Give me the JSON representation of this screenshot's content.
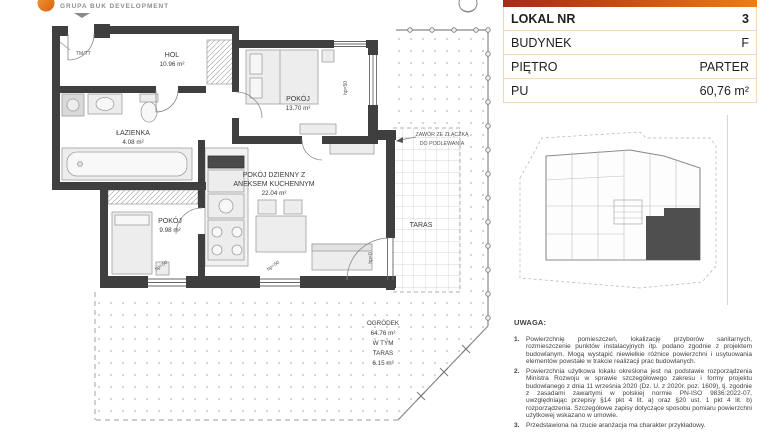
{
  "brand": {
    "logo_text": "GRUPA BUK DEVELOPMENT"
  },
  "info_table": {
    "rows": [
      {
        "label": "LOKAL NR",
        "value": "3"
      },
      {
        "label": "BUDYNEK",
        "value": "F"
      },
      {
        "label": "PIĘTRO",
        "value": "PARTER"
      },
      {
        "label": "PU",
        "value": "60,76 m²"
      }
    ]
  },
  "plan": {
    "rooms": {
      "hol": {
        "name": "HOL",
        "area": "10.96 m²"
      },
      "pokoj_top": {
        "name": "POKÓJ",
        "area": "13.70 m²"
      },
      "lazienka": {
        "name": "ŁAZIENKA",
        "area": "4.08 m²"
      },
      "living": {
        "name_line1": "POKÓJ DZIENNY Z",
        "name_line2": "ANEKSEM KUCHENNYM",
        "area": "22.04 m²"
      },
      "pokoj_bottom": {
        "name": "POKÓJ",
        "area": "9.98 m²"
      },
      "taras": {
        "name": "TARAS"
      },
      "ogrodek": {
        "name": "OGRÓDEK",
        "area": "64.76 m²",
        "sub1": "W TYM",
        "sub2": "TARAS",
        "sub3": "6.15 m²"
      }
    },
    "annotations": {
      "valve_line1": "ZAWÓR ZE ZŁĄCZKĄ",
      "valve_line2": "DO PODLEWANIA",
      "entry_door": "TM/TT",
      "window_sill": "hp=50",
      "door_sill": "hp=0"
    }
  },
  "notes": {
    "heading": "UWAGA:",
    "items": [
      {
        "num": "1.",
        "text": "Powierzchnię pomieszczeń, lokalizację przyborów sanitarnych, rozmieszczenie punktów instalacyjnych itp. podano zgodnie z projektem budowlanym. Mogą wystąpić niewielkie różnice powierzchni i usytuowania elementów powstałe w trakcie realizacji prac budowlanych."
      },
      {
        "num": "2.",
        "text": "Powierzchnia użytkowa lokalu określona jest na podstawie rozporządzenia Ministra Rozwoju w sprawie szczegółowego zakresu i formy projektu budowlanego z dnia 11 września 2020 (Dz. U. z 2020r. poz. 1609), tj. zgodnie z zasadami zawartymi w polskiej normie PN-ISO 9836:2022-07, uwzględniając przepisy §14 pkt 4 lit. a) oraz §20 ust. 1 pkt 4 lit. b) rozporządzenia. Szczegółowe zapisy dotyczące sposobu pomiaru powierzchni użytkowej wskazano w umowie."
      },
      {
        "num": "3.",
        "text": "Przedstawiona na rzucie aranżacja ma charakter przykładowy."
      }
    ]
  },
  "colors": {
    "accent_gradient_start": "#a8291b",
    "accent_gradient_end": "#ef7e12",
    "table_border": "#f4d7b8",
    "wall": "#3f3f3f",
    "highlighted_unit": "#4f4f4f"
  }
}
